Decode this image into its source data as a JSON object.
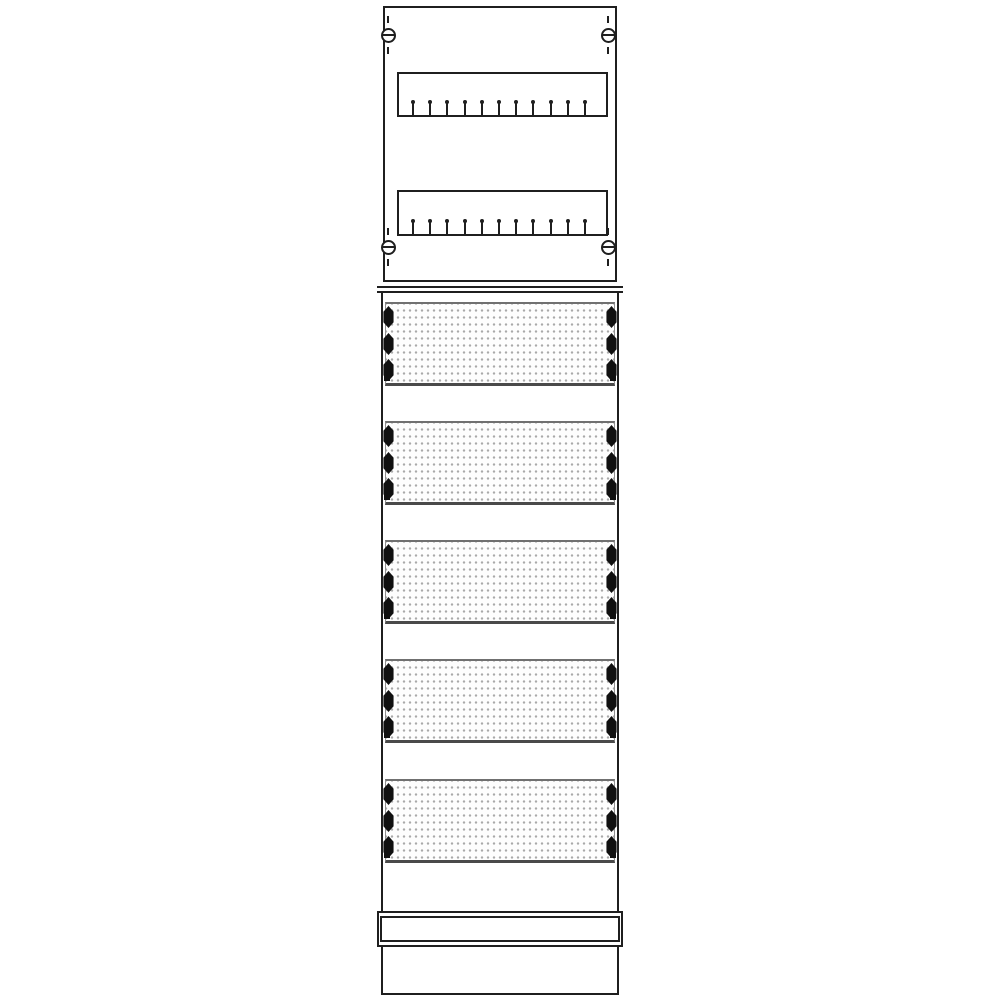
{
  "drawing": {
    "subject": "distribution-board-field-technical-line-drawing",
    "background_color": "#ffffff",
    "line_color": "#1f1f1f",
    "perforation_dot_color": "#a9a9a9",
    "fastener_color": "#101010",
    "cover_edge_dark_color": "#4a4a4a",
    "cover_edge_light_color": "#8f8f8f"
  },
  "meter_frame": {
    "screw_positions": [
      "top-left",
      "top-right",
      "bottom-left",
      "bottom-right"
    ],
    "rail_count": 2,
    "ticks_per_rail": 11
  },
  "module_field": {
    "cover_count": 5,
    "fasteners_per_side": 3,
    "corner_rivets_per_cover": 2
  },
  "base_section": {
    "cover_strip_count": 1
  }
}
